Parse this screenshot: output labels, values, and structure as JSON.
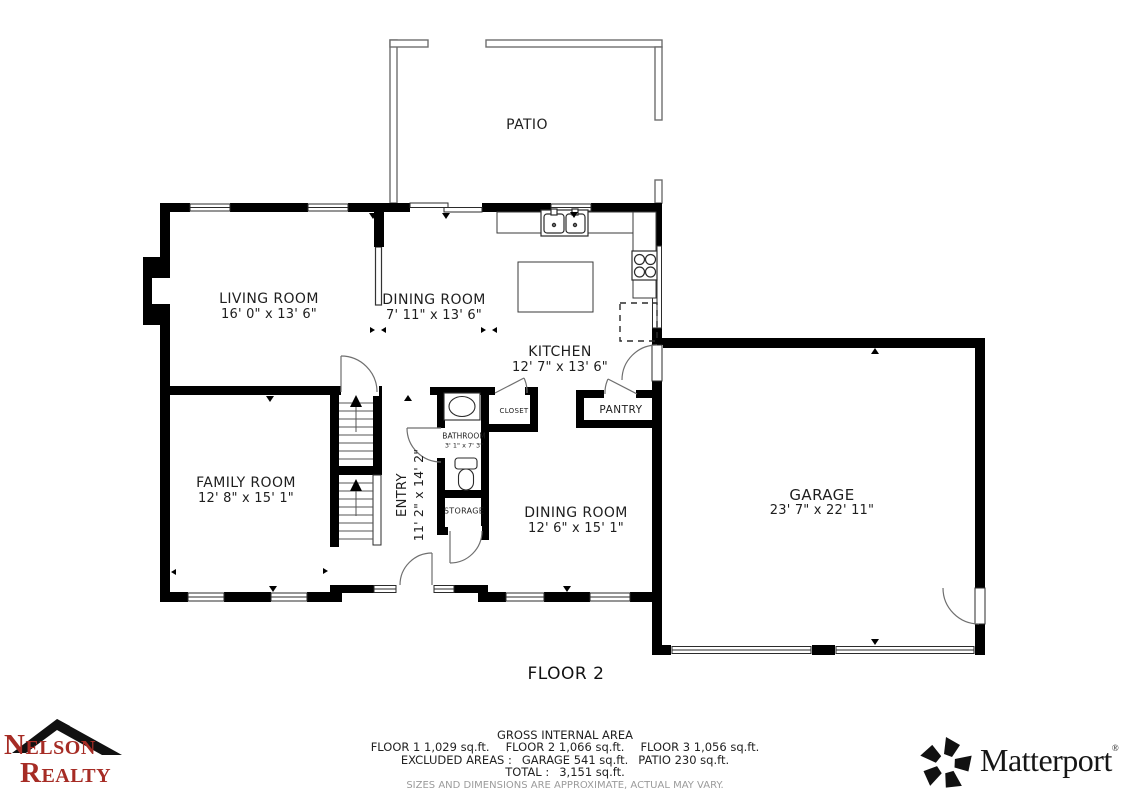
{
  "plan": {
    "floor_label": "FLOOR 2",
    "rooms": {
      "patio": "PATIO",
      "living_room": {
        "name": "LIVING ROOM",
        "dims": "16' 0\" x 13' 6\""
      },
      "dining_room_upper": {
        "name": "DINING ROOM",
        "dims": "7' 11\" x 13' 6\""
      },
      "kitchen": {
        "name": "KITCHEN",
        "dims": "12' 7\" x 13' 6\""
      },
      "family_room": {
        "name": "FAMILY ROOM",
        "dims": "12' 8\" x 15' 1\""
      },
      "entry": {
        "name": "ENTRY",
        "dims": "11' 2\" x 14' 2\""
      },
      "bathroom": {
        "name": "BATHROOM",
        "dims": "3' 1\" x 7' 3\""
      },
      "closet": "CLOSET",
      "storage": "STORAGE",
      "pantry": "PANTRY",
      "dining_room_lower": {
        "name": "DINING ROOM",
        "dims": "12' 6\" x 15' 1\""
      },
      "garage": {
        "name": "GARAGE",
        "dims": "23' 7\" x 22' 11\""
      }
    }
  },
  "footer": {
    "title": "GROSS INTERNAL AREA",
    "floors": [
      "FLOOR 1 1,029 sq.ft.",
      "FLOOR 2 1,066 sq.ft.",
      "FLOOR 3 1,056 sq.ft."
    ],
    "excluded_label": "EXCLUDED AREAS :",
    "excluded": [
      "GARAGE 541 sq.ft.",
      "PATIO 230 sq.ft."
    ],
    "total_label": "TOTAL :",
    "total_value": "3,151 sq.ft.",
    "disclaimer": "SIZES AND DIMENSIONS ARE APPROXIMATE, ACTUAL MAY VARY."
  },
  "branding": {
    "agency": {
      "line1_initial": "N",
      "line1_rest": "ELSON",
      "line2_initial": "R",
      "line2_rest": "EALTY",
      "color": "#A62C25"
    },
    "matterport": {
      "wordmark": "Matterport",
      "registered": "®"
    }
  }
}
